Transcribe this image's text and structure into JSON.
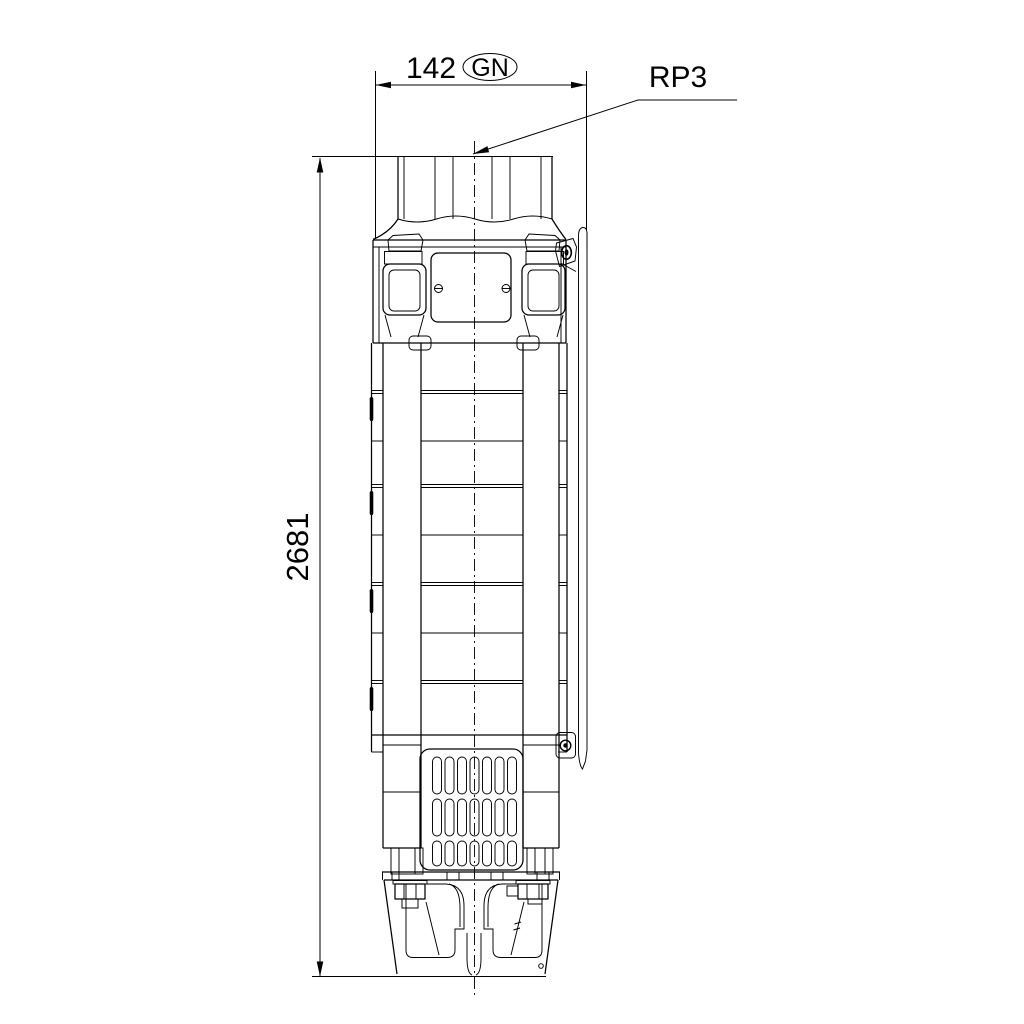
{
  "page": {
    "background": "#ffffff"
  },
  "drawing": {
    "kind": "dimensional-outline-drawing",
    "subject": "submersible borehole pump, front view",
    "line_color": "#000000",
    "dimensions": {
      "width": {
        "value": "142",
        "thread_tag": "GN"
      },
      "height": {
        "value": "2681"
      },
      "connection": {
        "label": "RP3"
      }
    }
  }
}
